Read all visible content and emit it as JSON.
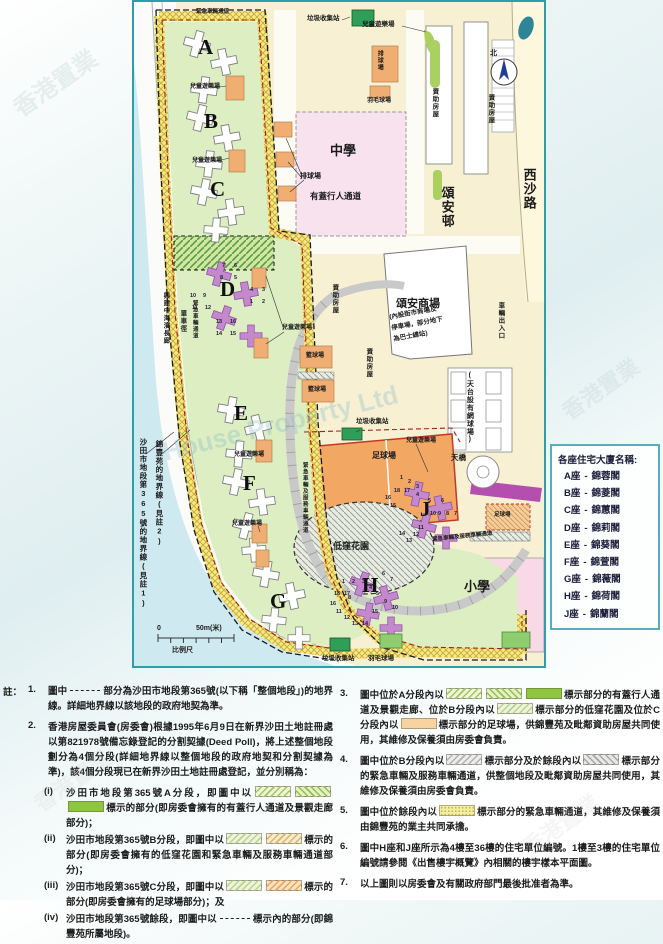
{
  "legend": {
    "title": "各座住宅大廈名稱:",
    "items": [
      {
        "block": "A座",
        "dash": "-",
        "name": "錦蓉閣"
      },
      {
        "block": "B座",
        "dash": "-",
        "name": "錦菱閣"
      },
      {
        "block": "C座",
        "dash": "-",
        "name": "錦蕙閣"
      },
      {
        "block": "D座",
        "dash": "-",
        "name": "錦莉閣"
      },
      {
        "block": "E座",
        "dash": "-",
        "name": "錦葵閣"
      },
      {
        "block": "F座",
        "dash": "-",
        "name": "錦萱閣"
      },
      {
        "block": "G座",
        "dash": "-",
        "name": "錦薇閣"
      },
      {
        "block": "H座",
        "dash": "-",
        "name": "錦荷閣"
      },
      {
        "block": "J座",
        "dash": "-",
        "name": "錦蘭閣"
      }
    ]
  },
  "map": {
    "labels": [
      {
        "t": "A",
        "x": 64,
        "y": 34,
        "big": 1,
        "n": "block-letter-a"
      },
      {
        "t": "B",
        "x": 70,
        "y": 108,
        "big": 1,
        "n": "block-letter-b"
      },
      {
        "t": "C",
        "x": 76,
        "y": 176,
        "big": 1,
        "n": "block-letter-c"
      },
      {
        "t": "D",
        "x": 86,
        "y": 276,
        "big": 1,
        "n": "block-letter-d"
      },
      {
        "t": "E",
        "x": 100,
        "y": 400,
        "big": 1,
        "n": "block-letter-e"
      },
      {
        "t": "F",
        "x": 109,
        "y": 470,
        "big": 1,
        "n": "block-letter-f"
      },
      {
        "t": "G",
        "x": 136,
        "y": 588,
        "big": 1,
        "n": "block-letter-g"
      },
      {
        "t": "H",
        "x": 228,
        "y": 572,
        "big": 1,
        "n": "block-letter-h"
      },
      {
        "t": "J",
        "x": 286,
        "y": 496,
        "big": 1,
        "n": "block-letter-j"
      },
      {
        "t": "中學",
        "x": 196,
        "y": 142,
        "s": 13,
        "n": "secondary-school-label"
      },
      {
        "t": "小學",
        "x": 330,
        "y": 578,
        "s": 13,
        "n": "primary-school-label"
      },
      {
        "t": "頌安邨",
        "x": 306,
        "y": 184,
        "s": 13,
        "v": 1,
        "n": "chung-on-estate-label"
      },
      {
        "t": "西沙路",
        "x": 388,
        "y": 166,
        "s": 13,
        "v": 1,
        "n": "sai-sha-road-label"
      },
      {
        "t": "頌安商場",
        "x": 262,
        "y": 297,
        "s": 11,
        "n": "shopping-centre-label"
      },
      {
        "t": "(內設街市商場及",
        "x": 255,
        "y": 313,
        "s": 6.5,
        "r": -10,
        "n": "shopping-centre-note-line1"
      },
      {
        "t": "停車場，部分地下",
        "x": 257,
        "y": 324,
        "s": 6.5,
        "r": -10,
        "n": "shopping-centre-note-line2"
      },
      {
        "t": "為巴士總站)",
        "x": 259,
        "y": 335,
        "s": 6.5,
        "r": -10,
        "n": "shopping-centre-note-line3"
      },
      {
        "t": "車輛出入口",
        "x": 362,
        "y": 300,
        "s": 6.5,
        "v": 1,
        "n": "vehicle-entrance-label"
      },
      {
        "t": "(天台設有網球場)",
        "x": 332,
        "y": 370,
        "s": 7,
        "v": 1,
        "n": "rooftop-tennis-court-label"
      },
      {
        "t": "天橋",
        "x": 317,
        "y": 452,
        "s": 7.5,
        "n": "footbridge-label"
      },
      {
        "t": "北",
        "x": 356,
        "y": 48,
        "s": 7,
        "n": "north-label"
      },
      {
        "t": "垃圾收集站",
        "x": 173,
        "y": 14,
        "s": 6.5,
        "n": "refuse-collection-point-label"
      },
      {
        "t": "垃圾收集站",
        "x": 222,
        "y": 417,
        "s": 6.5,
        "n": "refuse-collection-point-label"
      },
      {
        "t": "垃圾收集站",
        "x": 188,
        "y": 654,
        "s": 6.5,
        "n": "refuse-collection-point-label"
      },
      {
        "t": "羽毛球場",
        "x": 233,
        "y": 96,
        "s": 6,
        "n": "badminton-court-label"
      },
      {
        "t": "羽毛球場",
        "x": 234,
        "y": 654,
        "s": 6.5,
        "n": "badminton-court-label"
      },
      {
        "t": "排球場",
        "x": 242,
        "y": 48,
        "s": 6,
        "v": 1,
        "n": "volleyball-court-label"
      },
      {
        "t": "排球場",
        "x": 166,
        "y": 171,
        "s": 7,
        "n": "volleyball-court-label"
      },
      {
        "t": "籃球場",
        "x": 172,
        "y": 351,
        "s": 6,
        "n": "basketball-court-label"
      },
      {
        "t": "籃球場",
        "x": 174,
        "y": 385,
        "s": 6,
        "n": "basketball-court-label"
      },
      {
        "t": "足球場",
        "x": 238,
        "y": 450,
        "s": 8,
        "n": "football-pitch-label"
      },
      {
        "t": "足球場",
        "x": 360,
        "y": 511,
        "s": 5.5,
        "n": "football-pitch-label"
      },
      {
        "t": "低窪花園",
        "x": 199,
        "y": 540,
        "s": 9,
        "n": "sunken-garden-label"
      },
      {
        "t": "有蓋行人通道",
        "x": 176,
        "y": 190,
        "s": 8.5,
        "n": "covered-walkway-label"
      },
      {
        "t": "兒童遊樂場",
        "x": 228,
        "y": 20,
        "s": 6.5,
        "n": "playground-label"
      },
      {
        "t": "兒童遊樂場",
        "x": 56,
        "y": 82,
        "s": 6,
        "n": "playground-label"
      },
      {
        "t": "兒童遊樂場",
        "x": 58,
        "y": 156,
        "s": 6,
        "n": "playground-label"
      },
      {
        "t": "兒童遊樂場",
        "x": 148,
        "y": 323,
        "s": 6,
        "n": "playground-label"
      },
      {
        "t": "兒童遊樂場",
        "x": 100,
        "y": 450,
        "s": 6,
        "n": "playground-label"
      },
      {
        "t": "兒童遊樂場",
        "x": 98,
        "y": 519,
        "s": 6,
        "n": "playground-label"
      },
      {
        "t": "兒童遊樂場",
        "x": 272,
        "y": 436,
        "s": 6,
        "n": "playground-label"
      },
      {
        "t": "資助房屋",
        "x": 296,
        "y": 86,
        "s": 6.5,
        "v": 1,
        "n": "subsidised-housing-label"
      },
      {
        "t": "資助房屋",
        "x": 352,
        "y": 92,
        "s": 6.5,
        "v": 1,
        "n": "subsidised-housing-label"
      },
      {
        "t": "資助房屋",
        "x": 196,
        "y": 282,
        "s": 6.5,
        "v": 1,
        "n": "subsidised-housing-label"
      },
      {
        "t": "資助房屋",
        "x": 230,
        "y": 346,
        "s": 6.5,
        "v": 1,
        "n": "subsidised-housing-label"
      },
      {
        "t": "緊急車輛通道",
        "x": 62,
        "y": 8,
        "s": 5.5,
        "n": "emergency-vehicle-access-label"
      },
      {
        "t": "緊急車輛通道",
        "x": 57,
        "y": 298,
        "s": 5.5,
        "v": 1,
        "n": "emergency-vehicle-access-label"
      },
      {
        "t": "興建中海濱長廊",
        "x": 27,
        "y": 290,
        "s": 6.5,
        "v": 1,
        "n": "promenade-under-construction-label"
      },
      {
        "t": "單車徑",
        "x": 44,
        "y": 308,
        "s": 6.5,
        "v": 1,
        "n": "cycle-track-label"
      },
      {
        "t": "緊急車輛及服務車輛通道",
        "x": 167,
        "y": 460,
        "s": 5.5,
        "v": 1,
        "n": "emergency-service-vehicle-access-label"
      },
      {
        "t": "緊急車輛及服務車輛通道",
        "x": 298,
        "y": 536,
        "s": 5.5,
        "r": -6,
        "n": "emergency-service-vehicle-access-label"
      },
      {
        "t": "錦豐苑的地界線(見註2)",
        "x": 21,
        "y": 438,
        "s": 7.5,
        "v": 1,
        "n": "kam-fung-court-boundary-label"
      },
      {
        "t": "沙田市地段第365號的地界線(見註1)",
        "x": 5,
        "y": 436,
        "s": 7.5,
        "v": 1,
        "n": "lot-365-boundary-label"
      },
      {
        "t": "0",
        "x": 23,
        "y": 623,
        "s": 7,
        "n": "scale-zero"
      },
      {
        "t": "50m(米)",
        "x": 62,
        "y": 623,
        "s": 7,
        "n": "scale-max"
      },
      {
        "t": "比例尺",
        "x": 38,
        "y": 645,
        "s": 7,
        "n": "scale-bar-label"
      }
    ],
    "unit_numbers": {
      "d": [
        [
          "7",
          88,
          262
        ],
        [
          "6",
          100,
          262
        ],
        [
          "8",
          86,
          274
        ],
        [
          "5",
          100,
          274
        ],
        [
          "10",
          56,
          292
        ],
        [
          "9",
          69,
          292
        ],
        [
          "11",
          58,
          304
        ],
        [
          "12",
          71,
          304
        ],
        [
          "4",
          116,
          286
        ],
        [
          "3",
          128,
          286
        ],
        [
          "1",
          116,
          298
        ],
        [
          "2",
          128,
          298
        ],
        [
          "13",
          82,
          318
        ],
        [
          "16",
          96,
          318
        ],
        [
          "14",
          82,
          330
        ],
        [
          "15",
          96,
          330
        ]
      ],
      "h": [
        [
          "1",
          208,
          578
        ],
        [
          "2",
          218,
          578
        ],
        [
          "3",
          228,
          578
        ],
        [
          "4",
          235,
          584
        ],
        [
          "5",
          242,
          590
        ],
        [
          "6",
          248,
          570
        ],
        [
          "7",
          256,
          576
        ],
        [
          "8",
          214,
          594
        ],
        [
          "9",
          250,
          598
        ],
        [
          "10",
          258,
          604
        ],
        [
          "18",
          200,
          590
        ],
        [
          "17",
          210,
          590
        ],
        [
          "16",
          196,
          600
        ],
        [
          "15",
          238,
          608
        ],
        [
          "14",
          228,
          620
        ],
        [
          "13",
          218,
          620
        ],
        [
          "12",
          210,
          614
        ],
        [
          "11",
          202,
          608
        ]
      ],
      "j": [
        [
          "1",
          266,
          474
        ],
        [
          "2",
          274,
          478
        ],
        [
          "3",
          282,
          483
        ],
        [
          "4",
          282,
          491
        ],
        [
          "5",
          294,
          497
        ],
        [
          "6",
          307,
          497
        ],
        [
          "7",
          320,
          510
        ],
        [
          "8",
          312,
          510
        ],
        [
          "9",
          304,
          510
        ],
        [
          "10",
          296,
          510
        ],
        [
          "11",
          284,
          524
        ],
        [
          "12",
          279,
          531
        ],
        [
          "13",
          272,
          537
        ],
        [
          "14",
          265,
          530
        ],
        [
          "15",
          256,
          502
        ],
        [
          "16",
          251,
          494
        ],
        [
          "17",
          270,
          487
        ],
        [
          "18",
          260,
          487
        ]
      ]
    }
  },
  "notes": {
    "label": "註：",
    "left": [
      {
        "num": "1.",
        "segments": [
          {
            "t": "圖中"
          },
          {
            "dash": true
          },
          {
            "t": "部分為沙田市地段第365號(以下稱「整個地段」)的地界線。詳細地界線以該地段的政府地契為準。"
          }
        ]
      },
      {
        "num": "2.",
        "segments": [
          {
            "t": "香港房屋委員會(房委會)根據1995年6月9日在新界沙田土地註冊處以第821978號備忘錄登記的分割契據(Deed Poll)，將上述整個地段劃分為4個分段(詳細地界線以整個地段的政府地契和分割契據為準)，該4個分段現已在新界沙田土地註冊處登記，並分別稱為："
          }
        ],
        "subs": [
          {
            "num": "(i)",
            "segments": [
              {
                "t": "沙田市地段第365號A分段，即圖中以"
              },
              {
                "sw": "g1"
              },
              {
                "sw": "g2"
              },
              {
                "sw": "g3"
              },
              {
                "t": "標示的部分(即房委會擁有的有蓋行人通道及景觀走廊部分)；"
              }
            ]
          },
          {
            "num": "(ii)",
            "segments": [
              {
                "t": "沙田市地段第365號B分段，即圖中以"
              },
              {
                "sw": "gl"
              },
              {
                "sw": "o1"
              },
              {
                "t": "標示的部分(即房委會擁有的低窪花園和緊急車輛及服務車輛通道部分)；"
              }
            ]
          },
          {
            "num": "(iii)",
            "segments": [
              {
                "t": "沙田市地段第365號C分段，即圖中以"
              },
              {
                "sw": "gl"
              },
              {
                "sw": "o2"
              },
              {
                "t": "標示的部分(即房委會擁有的足球場部分)；及"
              }
            ]
          },
          {
            "num": "(iv)",
            "segments": [
              {
                "t": "沙田市地段第365號餘段，即圖中以"
              },
              {
                "dash": true
              },
              {
                "t": "標示內的部分(即錦豐苑所屬地段)。"
              }
            ]
          }
        ]
      }
    ],
    "right": [
      {
        "num": "3.",
        "segments": [
          {
            "t": "圖中位於A分段內以"
          },
          {
            "sw": "g1"
          },
          {
            "sw": "g2"
          },
          {
            "sw": "g3"
          },
          {
            "t": "標示部分的有蓋行人通道及景觀走廊、位於B分段內以"
          },
          {
            "sw": "gl"
          },
          {
            "t": "標示部分的低窪花園及位於C分段內以"
          },
          {
            "sw": "o3"
          },
          {
            "t": "標示部分的足球場，供錦豐苑及毗鄰資助房屋共同使用，其維修及保養須由房委會負責。"
          }
        ]
      },
      {
        "num": "4.",
        "segments": [
          {
            "t": "圖中位於B分段內以"
          },
          {
            "sw": "gy1"
          },
          {
            "t": "標示部分及於餘段內以"
          },
          {
            "sw": "gy2"
          },
          {
            "t": "標示部分的緊急車輛及服務車輛通道，供整個地段及毗鄰資助房屋共同使用，其維修及保養須由房委會負責。"
          }
        ]
      },
      {
        "num": "5.",
        "segments": [
          {
            "t": "圖中位於餘段內以"
          },
          {
            "sw": "yd"
          },
          {
            "t": "標示部分的緊急車輛通道，其維修及保養須由錦豐苑的業主共同承擔。"
          }
        ]
      },
      {
        "num": "6.",
        "segments": [
          {
            "t": "圖中H座和J座所示為4樓至36樓的住宅單位編號。1樓至3樓的住宅單位編號請參閱《出售樓宇概覽》內相關的樓宇樣本平面圖。"
          }
        ]
      },
      {
        "num": "7.",
        "segments": [
          {
            "t": "以上圖則以房委會及有關政府部門最後批准者為準。"
          }
        ]
      }
    ]
  },
  "watermarks": [
    {
      "text": "House Property Ltd",
      "x": 160,
      "y": 408,
      "rot": -14,
      "size": 26,
      "color": "#7fb9c9",
      "opacity": 0.3
    },
    {
      "text": "香港置業",
      "x": 6,
      "y": 64,
      "rot": -35,
      "size": 24,
      "color": "#93b2b2",
      "opacity": 0.18
    },
    {
      "text": "香港置業",
      "x": 556,
      "y": 372,
      "rot": -35,
      "size": 22,
      "color": "#93b2b2",
      "opacity": 0.15
    },
    {
      "text": "香港置業",
      "x": 28,
      "y": 764,
      "rot": -35,
      "size": 22,
      "color": "#b3b3b3",
      "opacity": 0.12
    },
    {
      "text": "香港置業",
      "x": 516,
      "y": 808,
      "rot": -35,
      "size": 22,
      "color": "#b3b3b3",
      "opacity": 0.12
    }
  ],
  "colors": {
    "map_border": "#2f9ea6",
    "estate_green": "#ddeec3",
    "boundary_band_yellow": "#f6ea82",
    "block_purple": "#c488cc",
    "court_orange": "#f0ae72",
    "pitch_orange": "#f2a763",
    "pitch_border_red": "#c0392b",
    "school_pink": "#f8e2ee",
    "sea_blue": "#cfe9f0",
    "refuse_green": "#2f9e57",
    "legend_border": "#57aebc"
  }
}
